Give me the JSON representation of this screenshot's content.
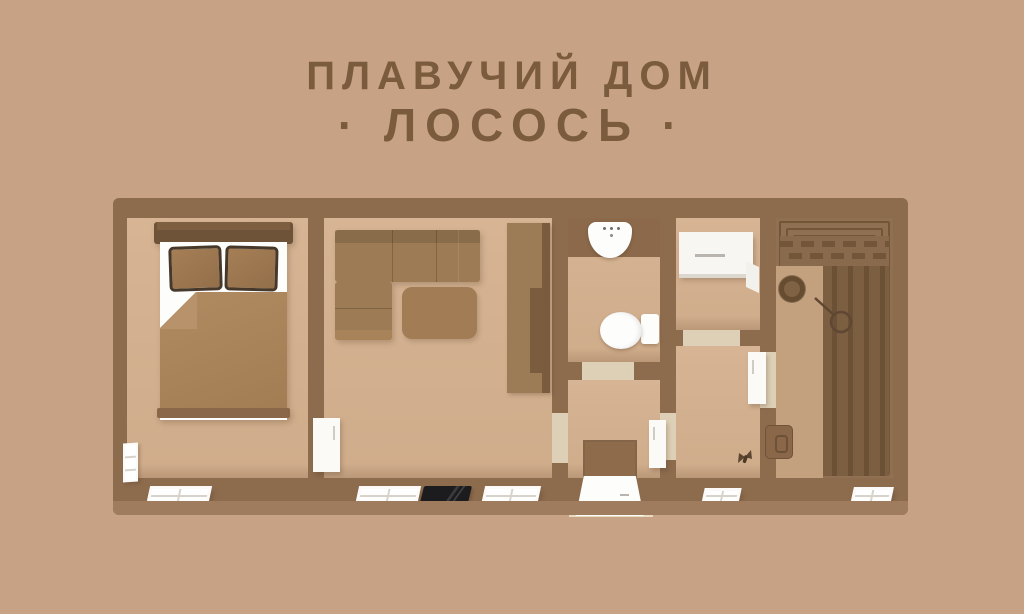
{
  "title": {
    "line1": "ПЛАВУЧИЙ ДОМ",
    "line2": "· ЛОСОСЬ ·"
  },
  "palette": {
    "background": "#c8a284",
    "walls": "#8d6b4d",
    "floor": "#d2b091",
    "title_text": "#7b5b3e",
    "furniture_wood": "#9b7954",
    "fixture_white": "#fbfaf7",
    "deck_plank_dark": "#6d5136"
  },
  "plan": {
    "rooms": [
      {
        "name": "bedroom"
      },
      {
        "name": "living-room"
      },
      {
        "name": "bathroom"
      },
      {
        "name": "entry-room"
      },
      {
        "name": "kitchen"
      },
      {
        "name": "hallway"
      },
      {
        "name": "terrace"
      }
    ]
  }
}
